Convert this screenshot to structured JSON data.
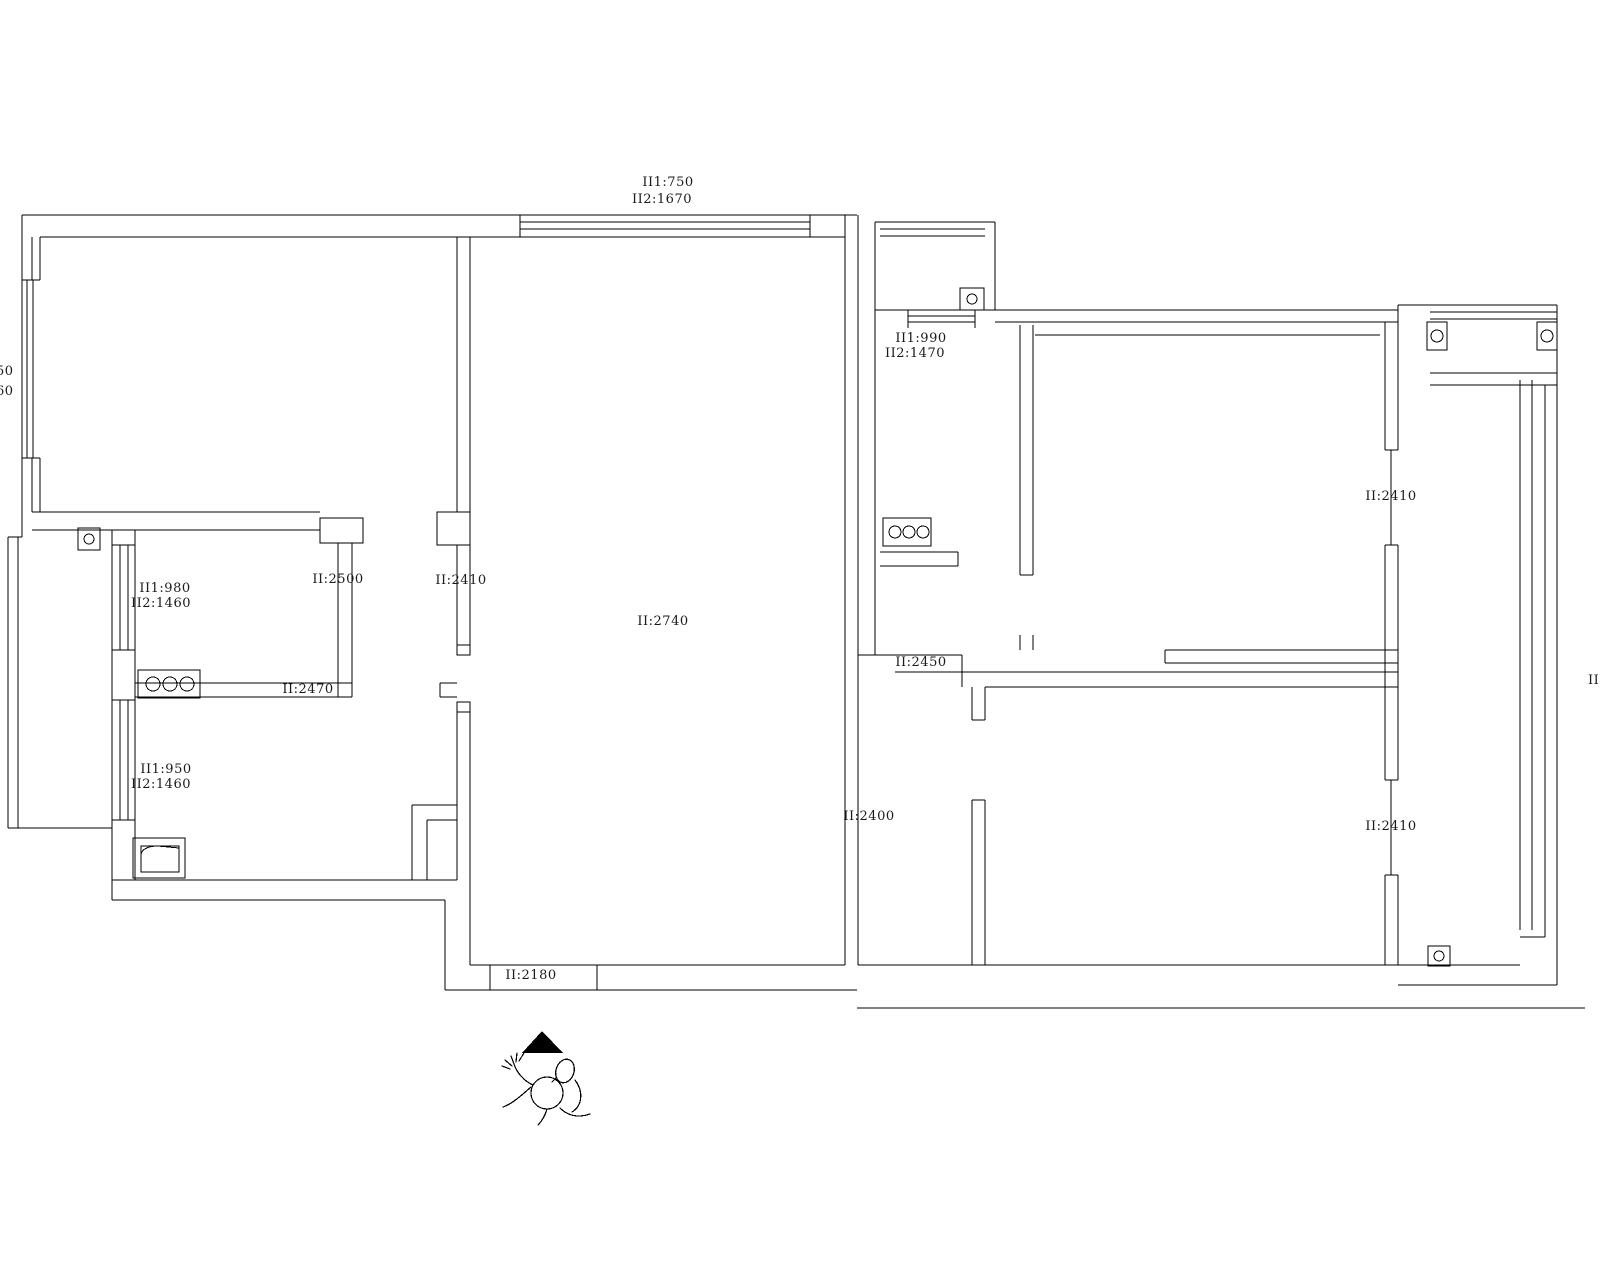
{
  "meta": {
    "type": "cad-floor-plan",
    "background_color": "#ffffff",
    "line_color": "#000000",
    "text_color": "#1a1a1a"
  },
  "labels": {
    "top_window_h1": "II1:750",
    "top_window_h2": "II2:1670",
    "left_edge_clip_1": "50",
    "left_edge_clip_2": "60",
    "kitchen2_window_h1": "II1:990",
    "kitchen2_window_h2": "II2:1470",
    "kitchen1_window_h1": "II1:980",
    "kitchen1_window_h2": "II2:1460",
    "kitchen1_opening": "II:2500",
    "living_opening": "II:2410",
    "living_height": "II:2740",
    "kitchen_bath_wall": "II:2470",
    "bath_window_h1": "II1:950",
    "bath_window_h2": "II2:1460",
    "hall_opening_b": "II:2450",
    "hall_opening_c": "II:2400",
    "entry_opening": "II:2180",
    "balcony_window_top": "II:2410",
    "balcony_window_bottom": "II:2410",
    "right_edge_clip": "II"
  },
  "symbols": {
    "north_arrow": "north-arrow",
    "person": "person-top-view-sketch",
    "cooktop_left": "three-burner-cooktop",
    "cooktop_right": "three-burner-cooktop",
    "gas_meter": "meter-box-with-circle",
    "drain_top_right": "floor-drain",
    "drain_bottom_right": "floor-drain",
    "balcony_posts": "corner-posts-with-circles",
    "basin": "wash-basin"
  }
}
